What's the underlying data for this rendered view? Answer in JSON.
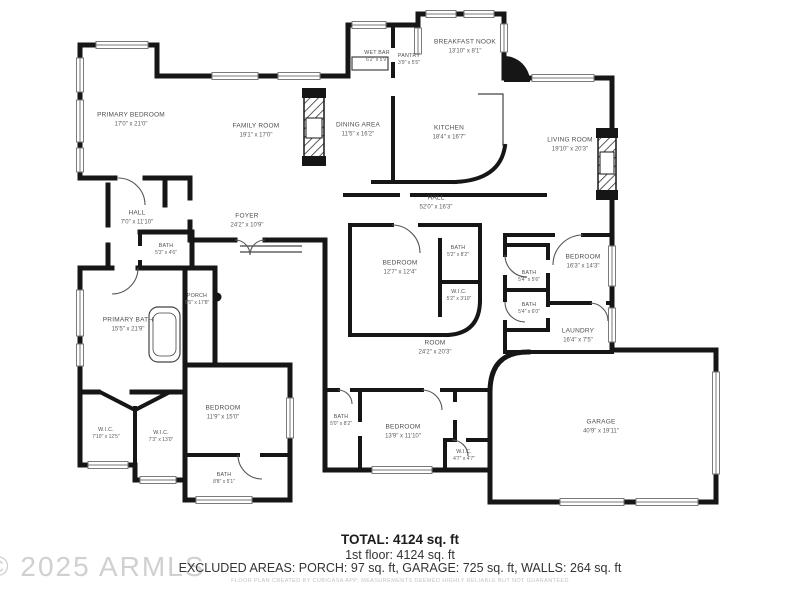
{
  "plan": {
    "rooms": [
      {
        "name": "PRIMARY BEDROOM",
        "dims": "17'0\" x 21'0\""
      },
      {
        "name": "FAMILY ROOM",
        "dims": "19'1\" x 17'0\""
      },
      {
        "name": "WET BAR",
        "dims": "6'2\" x 5'9\""
      },
      {
        "name": "PANTRY",
        "dims": "3'9\" x 5'5\""
      },
      {
        "name": "BREAKFAST NOOK",
        "dims": "13'10\" x 8'1\""
      },
      {
        "name": "DINING AREA",
        "dims": "11'5\" x 16'2\""
      },
      {
        "name": "KITCHEN",
        "dims": "18'4\" x 16'7\""
      },
      {
        "name": "LIVING ROOM",
        "dims": "19'10\" x 20'3\""
      },
      {
        "name": "HALL",
        "dims": "7'0\" x 11'10\""
      },
      {
        "name": "FOYER",
        "dims": "24'2\" x 10'9\""
      },
      {
        "name": "BATH",
        "dims": "5'3\" x 4'6\""
      },
      {
        "name": "HALL",
        "dims": "52'0\" x 16'3\""
      },
      {
        "name": "PORCH",
        "dims": "5'5\" x 17'8\""
      },
      {
        "name": "PRIMARY BATH",
        "dims": "15'5\" x 21'9\""
      },
      {
        "name": "BEDROOM",
        "dims": "12'7\" x 12'4\""
      },
      {
        "name": "BATH",
        "dims": "5'2\" x 8'2\""
      },
      {
        "name": "W.I.C.",
        "dims": "5'2\" x 3'10\""
      },
      {
        "name": "BATH",
        "dims": "5'4\" x 5'6\""
      },
      {
        "name": "BEDROOM",
        "dims": "16'3\" x 14'3\""
      },
      {
        "name": "BATH",
        "dims": "5'4\" x 6'0\""
      },
      {
        "name": "LAUNDRY",
        "dims": "16'4\" x 7'5\""
      },
      {
        "name": "ROOM",
        "dims": "24'2\" x 20'3\""
      },
      {
        "name": "W.I.C.",
        "dims": "7'10\" x 12'5\""
      },
      {
        "name": "W.I.C.",
        "dims": "7'3\" x 13'0\""
      },
      {
        "name": "BEDROOM",
        "dims": "11'9\" x 15'0\""
      },
      {
        "name": "BATH",
        "dims": "5'0\" x 8'2\""
      },
      {
        "name": "BEDROOM",
        "dims": "13'9\" x 11'10\""
      },
      {
        "name": "W.I.C.",
        "dims": "4'7\" x 4'7\""
      },
      {
        "name": "BATH",
        "dims": "8'8\" x 5'1\""
      },
      {
        "name": "GARAGE",
        "dims": "40'9\" x 19'11\""
      }
    ],
    "footer": {
      "total": "TOTAL: 4124 sq. ft",
      "floor1": "1st floor: 4124 sq. ft",
      "excluded": "EXCLUDED AREAS: PORCH: 97 sq. ft, GARAGE: 725 sq. ft, WALLS: 264 sq. ft",
      "disclaimer": "FLOOR PLAN CREATED BY CUBICASA APP; MEASUREMENTS DEEMED HIGHLY RELIABLE BUT NOT GUARANTEED"
    },
    "watermark": "© 2025 ARMLS",
    "colors": {
      "wall": "#161616",
      "label": "#4e4e4e",
      "watermark": "#d0d0d0"
    }
  }
}
